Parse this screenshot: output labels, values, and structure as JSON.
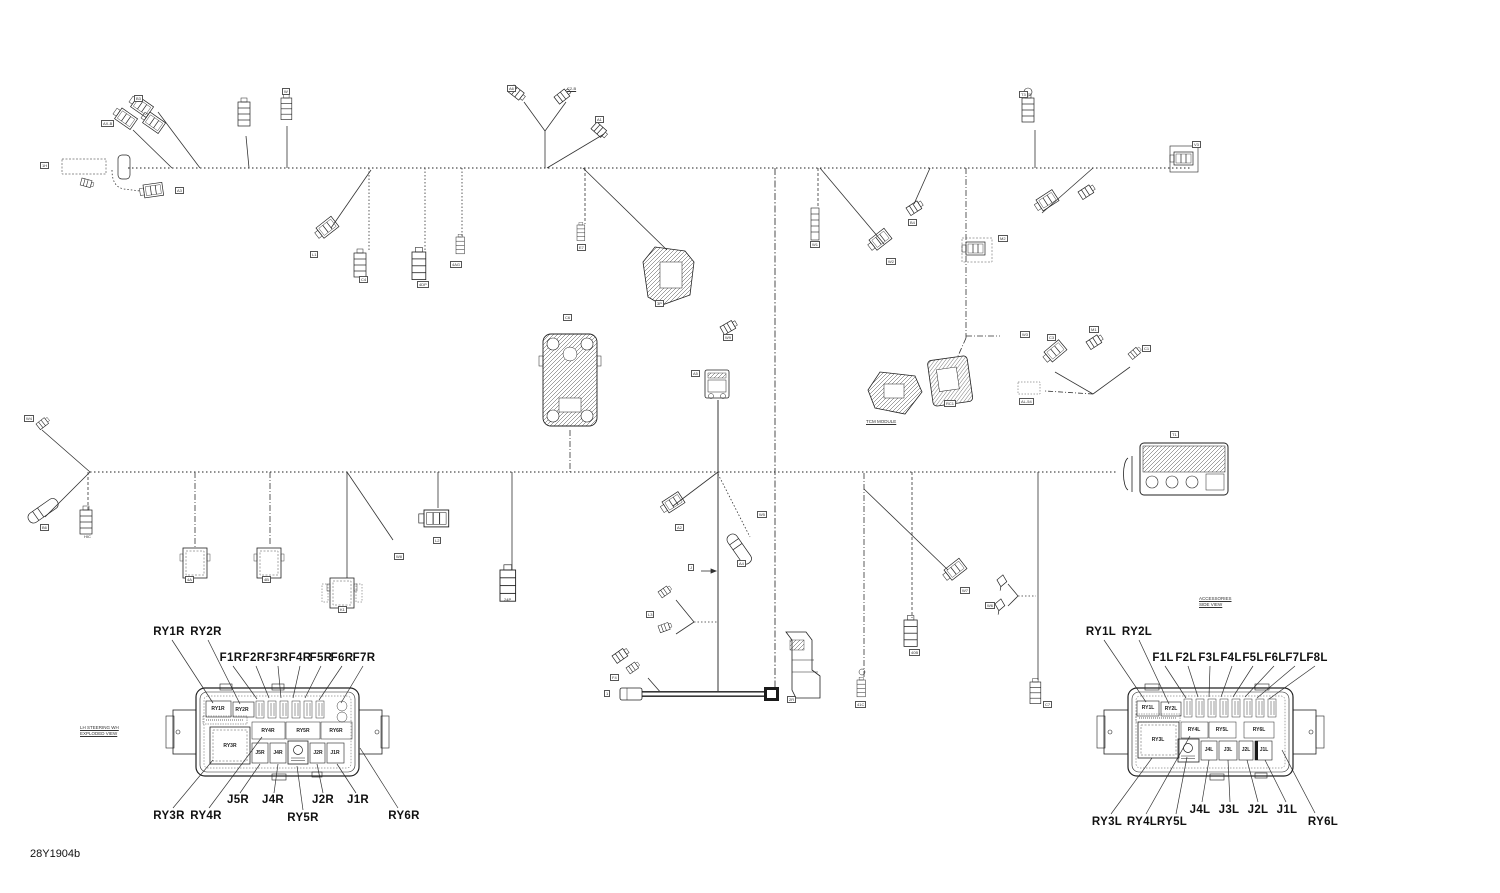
{
  "doc": {
    "part_number": "28Y1904b"
  },
  "callouts": [
    {
      "t": "RY1R",
      "x": 169,
      "y": 626
    },
    {
      "t": "RY2R",
      "x": 206,
      "y": 626
    },
    {
      "t": "F1R",
      "x": 231,
      "y": 652
    },
    {
      "t": "F2R",
      "x": 254,
      "y": 652
    },
    {
      "t": "F3R",
      "x": 277,
      "y": 652
    },
    {
      "t": "F4R",
      "x": 300,
      "y": 652
    },
    {
      "t": "F5R",
      "x": 321,
      "y": 652
    },
    {
      "t": "F6R",
      "x": 342,
      "y": 652
    },
    {
      "t": "F7R",
      "x": 364,
      "y": 652
    },
    {
      "t": "RY3R",
      "x": 169,
      "y": 810
    },
    {
      "t": "RY4R",
      "x": 206,
      "y": 810
    },
    {
      "t": "J5R",
      "x": 238,
      "y": 794
    },
    {
      "t": "J4R",
      "x": 273,
      "y": 794
    },
    {
      "t": "RY5R",
      "x": 303,
      "y": 812
    },
    {
      "t": "J2R",
      "x": 323,
      "y": 794
    },
    {
      "t": "J1R",
      "x": 358,
      "y": 794
    },
    {
      "t": "RY6R",
      "x": 404,
      "y": 810
    },
    {
      "t": "RY1L",
      "x": 1101,
      "y": 626
    },
    {
      "t": "RY2L",
      "x": 1137,
      "y": 626
    },
    {
      "t": "F1L",
      "x": 1163,
      "y": 652
    },
    {
      "t": "F2L",
      "x": 1186,
      "y": 652
    },
    {
      "t": "F3L",
      "x": 1209,
      "y": 652
    },
    {
      "t": "F4L",
      "x": 1231,
      "y": 652
    },
    {
      "t": "F5L",
      "x": 1253,
      "y": 652
    },
    {
      "t": "F6L",
      "x": 1275,
      "y": 652
    },
    {
      "t": "F7L",
      "x": 1296,
      "y": 652
    },
    {
      "t": "F8L",
      "x": 1317,
      "y": 652
    },
    {
      "t": "RY3L",
      "x": 1107,
      "y": 816
    },
    {
      "t": "RY4L",
      "x": 1142,
      "y": 816
    },
    {
      "t": "RY5L",
      "x": 1172,
      "y": 816
    },
    {
      "t": "J4L",
      "x": 1200,
      "y": 804
    },
    {
      "t": "J3L",
      "x": 1229,
      "y": 804
    },
    {
      "t": "J2L",
      "x": 1258,
      "y": 804
    },
    {
      "t": "J1L",
      "x": 1287,
      "y": 804
    },
    {
      "t": "RY6L",
      "x": 1323,
      "y": 816
    }
  ],
  "fusebox_r_inner": [
    {
      "t": "RY1R",
      "x": 218,
      "y": 709
    },
    {
      "t": "RY2R",
      "x": 242,
      "y": 710
    },
    {
      "t": "RY3R",
      "x": 230,
      "y": 746
    },
    {
      "t": "RY4R",
      "x": 268,
      "y": 731
    },
    {
      "t": "RY5R",
      "x": 303,
      "y": 731
    },
    {
      "t": "RY6R",
      "x": 336,
      "y": 731
    },
    {
      "t": "J5R",
      "x": 260,
      "y": 753
    },
    {
      "t": "J4R",
      "x": 278,
      "y": 753
    },
    {
      "t": "J2R",
      "x": 318,
      "y": 753
    },
    {
      "t": "J1R",
      "x": 335,
      "y": 753
    }
  ],
  "fusebox_l_inner": [
    {
      "t": "RY1L",
      "x": 1148,
      "y": 708
    },
    {
      "t": "RY2L",
      "x": 1171,
      "y": 709
    },
    {
      "t": "RY3L",
      "x": 1158,
      "y": 740
    },
    {
      "t": "RY4L",
      "x": 1194,
      "y": 730
    },
    {
      "t": "RY5L",
      "x": 1222,
      "y": 730
    },
    {
      "t": "RY6L",
      "x": 1259,
      "y": 730
    },
    {
      "t": "J4L",
      "x": 1209,
      "y": 750
    },
    {
      "t": "J3L",
      "x": 1228,
      "y": 750
    },
    {
      "t": "J2L",
      "x": 1246,
      "y": 750
    },
    {
      "t": "J1L",
      "x": 1264,
      "y": 750
    }
  ],
  "connector_codes": [
    {
      "t": "1H",
      "x": 40,
      "y": 162
    },
    {
      "t": "AX-B",
      "x": 101,
      "y": 120
    },
    {
      "t": "B3",
      "x": 134,
      "y": 95
    },
    {
      "t": "W",
      "x": 282,
      "y": 88
    },
    {
      "t": "A3",
      "x": 175,
      "y": 187
    },
    {
      "t": "L1",
      "x": 310,
      "y": 251
    },
    {
      "t": "C4",
      "x": 359,
      "y": 276
    },
    {
      "t": "4DP",
      "x": 417,
      "y": 281
    },
    {
      "t": "4AG",
      "x": 450,
      "y": 261
    },
    {
      "t": "A6",
      "x": 507,
      "y": 85
    },
    {
      "t": "C2-B",
      "x": 566,
      "y": 86,
      "u": true
    },
    {
      "t": "A1",
      "x": 595,
      "y": 116
    },
    {
      "t": "E7",
      "x": 577,
      "y": 244
    },
    {
      "t": "3P",
      "x": 655,
      "y": 300
    },
    {
      "t": "W1",
      "x": 810,
      "y": 241
    },
    {
      "t": "W2",
      "x": 886,
      "y": 258
    },
    {
      "t": "B4",
      "x": 908,
      "y": 219
    },
    {
      "t": "M2",
      "x": 998,
      "y": 235
    },
    {
      "t": "W3",
      "x": 1020,
      "y": 331
    },
    {
      "t": "RC1",
      "x": 944,
      "y": 400
    },
    {
      "t": "C3",
      "x": 1047,
      "y": 334
    },
    {
      "t": "M1",
      "x": 1089,
      "y": 326
    },
    {
      "t": "C1",
      "x": 1142,
      "y": 345
    },
    {
      "t": "AL-54",
      "x": 1019,
      "y": 398
    },
    {
      "t": "T1",
      "x": 1170,
      "y": 431
    },
    {
      "t": "T3",
      "x": 1019,
      "y": 91
    },
    {
      "t": "V3",
      "x": 1192,
      "y": 141
    },
    {
      "t": "W4",
      "x": 24,
      "y": 415
    },
    {
      "t": "B6",
      "x": 40,
      "y": 524
    },
    {
      "t": "HIC",
      "x": 83,
      "y": 534,
      "plain": true
    },
    {
      "t": "4A",
      "x": 185,
      "y": 576
    },
    {
      "t": "4B",
      "x": 262,
      "y": 576
    },
    {
      "t": "K1",
      "x": 338,
      "y": 606
    },
    {
      "t": "W8",
      "x": 394,
      "y": 553
    },
    {
      "t": "L2",
      "x": 433,
      "y": 537
    },
    {
      "t": "24P",
      "x": 503,
      "y": 597,
      "plain": true
    },
    {
      "t": "C6",
      "x": 563,
      "y": 314
    },
    {
      "t": "W9",
      "x": 723,
      "y": 334
    },
    {
      "t": "A5",
      "x": 691,
      "y": 370
    },
    {
      "t": "A2",
      "x": 675,
      "y": 524
    },
    {
      "t": "A4",
      "x": 737,
      "y": 560
    },
    {
      "t": "W5",
      "x": 757,
      "y": 511
    },
    {
      "t": "J",
      "x": 688,
      "y": 564
    },
    {
      "t": "L3",
      "x": 646,
      "y": 611
    },
    {
      "t": "F4",
      "x": 610,
      "y": 674
    },
    {
      "t": "1",
      "x": 604,
      "y": 690
    },
    {
      "t": "2R",
      "x": 787,
      "y": 696
    },
    {
      "t": "41C",
      "x": 855,
      "y": 701
    },
    {
      "t": "40B",
      "x": 909,
      "y": 649
    },
    {
      "t": "W6",
      "x": 985,
      "y": 602
    },
    {
      "t": "W7",
      "x": 960,
      "y": 587
    },
    {
      "t": "C7",
      "x": 1043,
      "y": 701
    }
  ],
  "notes": [
    {
      "x": 80,
      "y": 725,
      "lines": [
        "LH STEERING WH",
        "EXPLODED VIEW"
      ]
    },
    {
      "x": 1199,
      "y": 596,
      "lines": [
        "ACCESSORIES",
        "SIDE VIEW"
      ]
    },
    {
      "x": 866,
      "y": 419,
      "lines": [
        "TCM MODULE"
      ]
    }
  ]
}
